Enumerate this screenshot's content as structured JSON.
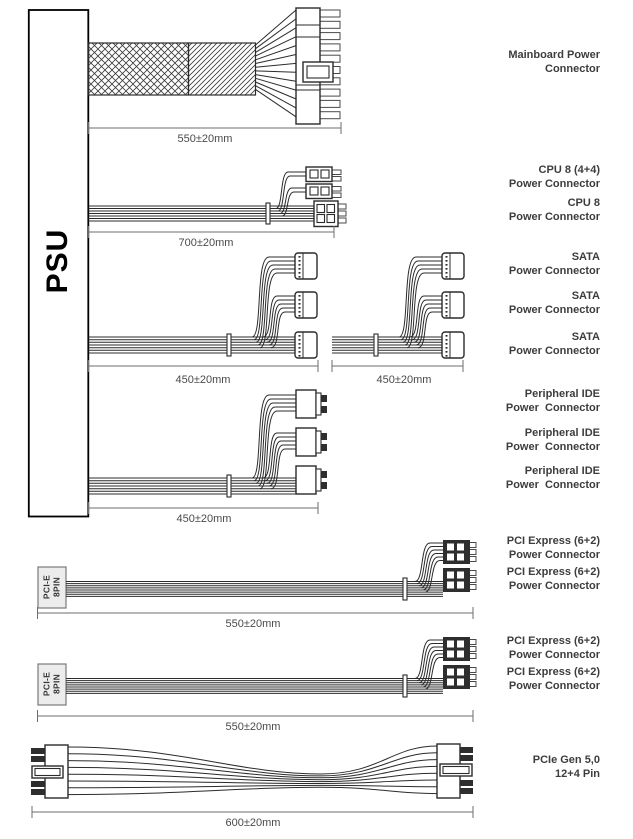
{
  "psu_label": "PSU",
  "pcie_plug_label": {
    "line1": "PCI-E",
    "line2": "8PIN"
  },
  "dimensions": {
    "mainboard": "550±20mm",
    "cpu": "700±20mm",
    "sata1": "450±20mm",
    "sata2": "450±20mm",
    "ide": "450±20mm",
    "pcie1": "550±20mm",
    "pcie2": "550±20mm",
    "gen5": "600±20mm"
  },
  "connector_labels": [
    {
      "line1": "Mainboard Power",
      "line2": "Connector"
    },
    {
      "line1": "CPU 8 (4+4)",
      "line2": "Power Connector"
    },
    {
      "line1": "CPU 8",
      "line2": "Power Connector"
    },
    {
      "line1": "SATA",
      "line2": "Power Connector"
    },
    {
      "line1": "SATA",
      "line2": "Power Connector"
    },
    {
      "line1": "SATA",
      "line2": "Power Connector"
    },
    {
      "line1": "Peripheral IDE",
      "line2": "Power  Connector"
    },
    {
      "line1": "Peripheral IDE",
      "line2": "Power  Connector"
    },
    {
      "line1": "Peripheral IDE",
      "line2": "Power  Connector"
    },
    {
      "line1": "PCI Express (6+2)",
      "line2": "Power Connector"
    },
    {
      "line1": "PCI Express (6+2)",
      "line2": "Power Connector"
    },
    {
      "line1": "PCI Express (6+2)",
      "line2": "Power Connector"
    },
    {
      "line1": "PCI Express (6+2)",
      "line2": "Power Connector"
    },
    {
      "line1": "PCIe Gen 5,0",
      "line2": "12+4 Pin"
    }
  ]
}
